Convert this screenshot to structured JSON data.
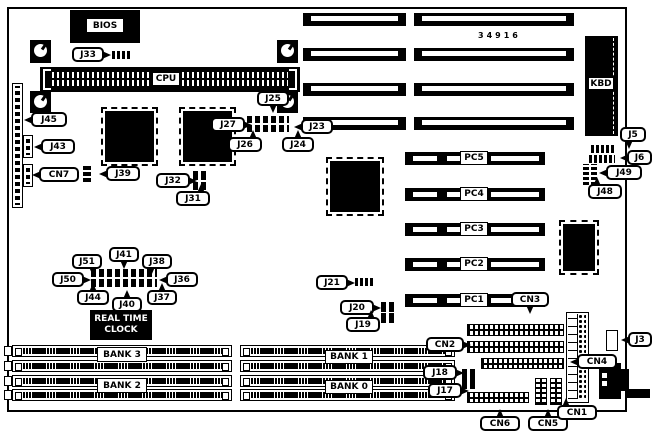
{
  "part_number": "34916",
  "chips": {
    "bios": "BIOS",
    "cpu": "CPU",
    "kbd": "KBD",
    "rtc_line1": "REAL TIME",
    "rtc_line2": "CLOCK"
  },
  "pc_slots": [
    {
      "label": "PC5"
    },
    {
      "label": "PC4"
    },
    {
      "label": "PC3"
    },
    {
      "label": "PC2"
    },
    {
      "label": "PC1"
    }
  ],
  "banks": [
    {
      "label": "BANK 3"
    },
    {
      "label": "BANK 2"
    },
    {
      "label": "BANK 1"
    },
    {
      "label": "BANK 0"
    }
  ],
  "callouts": [
    {
      "label": "J33",
      "x": 72,
      "y": 47,
      "w": 32,
      "dir": "right"
    },
    {
      "label": "J45",
      "x": 31,
      "y": 112,
      "w": 36,
      "dir": "left"
    },
    {
      "label": "J43",
      "x": 41,
      "y": 139,
      "w": 34,
      "dir": "left"
    },
    {
      "label": "CN7",
      "x": 39,
      "y": 167,
      "w": 40,
      "dir": "left"
    },
    {
      "label": "J39",
      "x": 106,
      "y": 166,
      "w": 34,
      "dir": "left"
    },
    {
      "label": "J32",
      "x": 156,
      "y": 173,
      "w": 34,
      "dir": "right"
    },
    {
      "label": "J31",
      "x": 176,
      "y": 191,
      "w": 34,
      "dir": "upright"
    },
    {
      "label": "J27",
      "x": 211,
      "y": 117,
      "w": 34,
      "dir": "right"
    },
    {
      "label": "J25",
      "x": 257,
      "y": 91,
      "w": 32,
      "dir": "down"
    },
    {
      "label": "J23",
      "x": 301,
      "y": 119,
      "w": 32,
      "dir": "left"
    },
    {
      "label": "J26",
      "x": 228,
      "y": 137,
      "w": 34,
      "dir": "upright"
    },
    {
      "label": "J24",
      "x": 282,
      "y": 137,
      "w": 32,
      "dir": "up"
    },
    {
      "label": "J5",
      "x": 620,
      "y": 127,
      "w": 26,
      "dir": "downleft"
    },
    {
      "label": "J6",
      "x": 627,
      "y": 150,
      "w": 25,
      "dir": "left"
    },
    {
      "label": "J49",
      "x": 606,
      "y": 165,
      "w": 36,
      "dir": "left"
    },
    {
      "label": "J48",
      "x": 588,
      "y": 184,
      "w": 34,
      "dir": "upleft"
    },
    {
      "label": "J51",
      "x": 72,
      "y": 254,
      "w": 30,
      "dir": "downright"
    },
    {
      "label": "J41",
      "x": 109,
      "y": 247,
      "w": 30,
      "dir": "down"
    },
    {
      "label": "J38",
      "x": 142,
      "y": 254,
      "w": 30,
      "dir": "downleft"
    },
    {
      "label": "J50",
      "x": 52,
      "y": 272,
      "w": 32,
      "dir": "right"
    },
    {
      "label": "J36",
      "x": 166,
      "y": 272,
      "w": 32,
      "dir": "left"
    },
    {
      "label": "J44",
      "x": 77,
      "y": 290,
      "w": 32,
      "dir": "up"
    },
    {
      "label": "J40",
      "x": 112,
      "y": 297,
      "w": 30,
      "dir": "up"
    },
    {
      "label": "J37",
      "x": 147,
      "y": 290,
      "w": 30,
      "dir": "up"
    },
    {
      "label": "J21",
      "x": 316,
      "y": 275,
      "w": 32,
      "dir": "right"
    },
    {
      "label": "J20",
      "x": 340,
      "y": 300,
      "w": 34,
      "dir": "right"
    },
    {
      "label": "J19",
      "x": 346,
      "y": 317,
      "w": 34,
      "dir": "upright"
    },
    {
      "label": "CN3",
      "x": 511,
      "y": 292,
      "w": 38,
      "dir": "down"
    },
    {
      "label": "CN2",
      "x": 426,
      "y": 337,
      "w": 38,
      "dir": "right"
    },
    {
      "label": "CN4",
      "x": 577,
      "y": 354,
      "w": 40,
      "dir": "left"
    },
    {
      "label": "J3",
      "x": 628,
      "y": 332,
      "w": 24,
      "dir": "left"
    },
    {
      "label": "J18",
      "x": 423,
      "y": 365,
      "w": 34,
      "dir": "right"
    },
    {
      "label": "J17",
      "x": 428,
      "y": 383,
      "w": 34,
      "dir": "right"
    },
    {
      "label": "CN6",
      "x": 480,
      "y": 416,
      "w": 40,
      "dir": "up"
    },
    {
      "label": "CN5",
      "x": 528,
      "y": 416,
      "w": 40,
      "dir": "up"
    },
    {
      "label": "CN1",
      "x": 557,
      "y": 405,
      "w": 40,
      "dir": "upleft"
    }
  ]
}
